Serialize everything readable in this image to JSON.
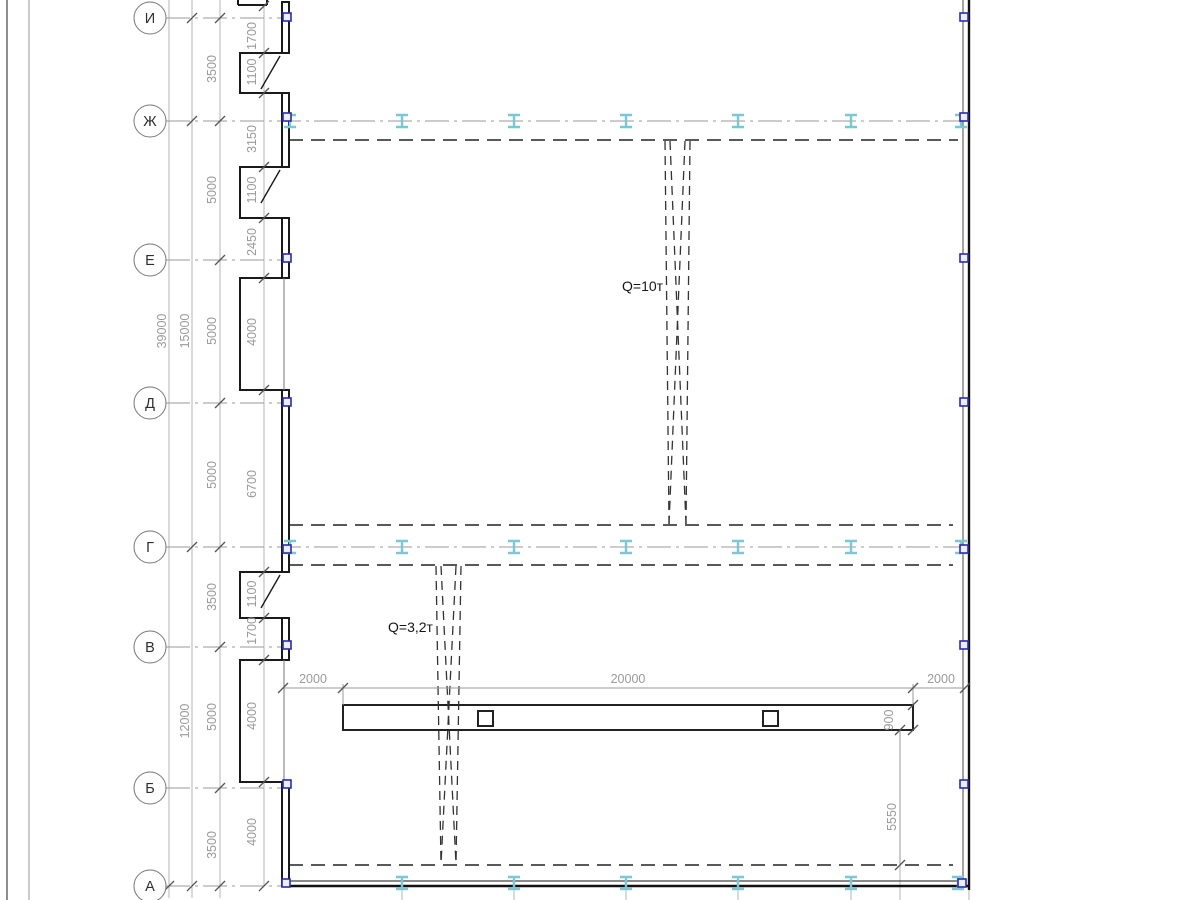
{
  "drawing": {
    "axis_labels": [
      "И",
      "Ж",
      "Е",
      "Д",
      "Г",
      "В",
      "Б",
      "А"
    ],
    "left_dims": {
      "overall": "39000",
      "block_upper": "15000",
      "block_lower": "12000",
      "axis_spacings": [
        "3500",
        "5000",
        "5000",
        "5000",
        "3500",
        "5000",
        "3500"
      ],
      "wall_segments": [
        "1700",
        "1100",
        "3150",
        "1100",
        "2450",
        "4000",
        "6700",
        "1100",
        "1700",
        "4000",
        "4000"
      ]
    },
    "bottom_dims": {
      "left_offset": "2000",
      "span": "20000",
      "right_offset": "2000"
    },
    "right_dims": {
      "beam_width": "900",
      "offset": "5550"
    },
    "cranes": [
      {
        "capacity_label": "Q=10т"
      },
      {
        "capacity_label": "Q=3,2т"
      }
    ],
    "colors": {
      "rail_symbol": "#7cc8d2",
      "column_marker_border": "#2b2bb0",
      "wall_line": "#1a1a1a",
      "grid_line": "#9a9a9a",
      "dim_text": "#9a9a9a"
    }
  }
}
